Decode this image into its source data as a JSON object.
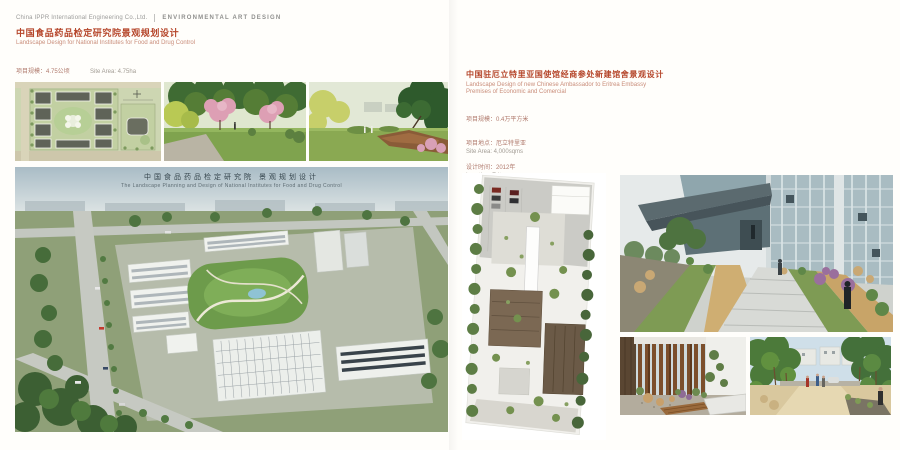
{
  "header": {
    "company": "China IPPR International Engineering Co.,Ltd.",
    "department": "ENVIRONMENTAL ART DESIGN"
  },
  "colors": {
    "accent_red": "#b5452a",
    "subtitle_red": "#c98d7a",
    "meta_red": "#b07a6d",
    "meta_grey": "#a29c94",
    "header_grey": "#9b9b99"
  },
  "project1": {
    "title_zh": "中国食品药品检定研究院景观规划设计",
    "title_en": "Landscape Design for National Institutes for Food and Drug Control",
    "meta_zh": [
      "项目规模：4.75公顷",
      "项目地点：北京",
      "设计时间：2011"
    ],
    "meta_en": [
      "Site Area: 4.75ha",
      "Location: Beijing",
      "Design Time: 2011"
    ],
    "aerial_caption_zh": "中国食品药品检定研究院 景观规划设计",
    "aerial_caption_en": "The Landscape Planning and Design of National Institutes for Food and Drug Control",
    "images": {
      "masterplan": "site-master-plan",
      "blossom": "park-blossom-rendering",
      "vista": "park-vista-rendering",
      "aerial": "campus-aerial-rendering"
    }
  },
  "project2": {
    "title_zh": "中国驻厄立特里亚国使馆经商参处新建馆舍景观设计",
    "title_en_line1": "Landscape Design of new Chinese Ambassador to Eritrea Embassy",
    "title_en_line2": "Premises of Economic and Comercial",
    "meta_zh": [
      "项目规模：0.4万平方米",
      "项目地点：厄立特里亚",
      "设计时间：2012年",
      "竣工时间：2013年"
    ],
    "meta_en": [
      "Site Area: 4,000sqms",
      "Location: Eritrea",
      "Design Time: 2012",
      "Completion Time: 2013"
    ],
    "images": {
      "siteplan": "embassy-site-plan",
      "perspective": "embassy-courtyard-rendering",
      "court": "timber-screen-garden-rendering",
      "path": "tree-allee-path-rendering"
    }
  }
}
